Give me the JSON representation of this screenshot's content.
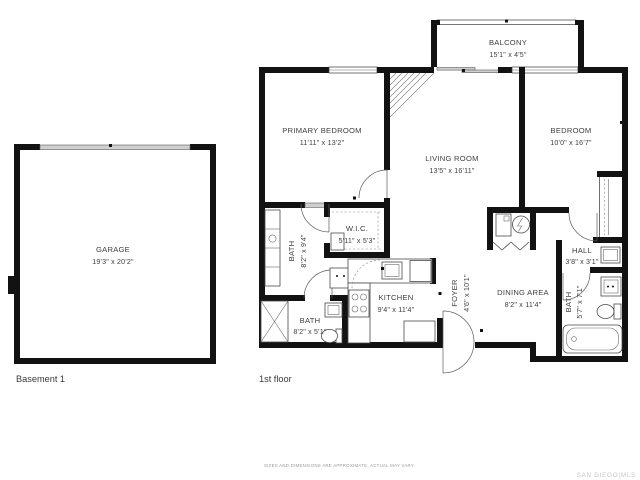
{
  "plan": {
    "basement": {
      "floor_label": "Basement 1",
      "rooms": {
        "garage": {
          "name": "GARAGE",
          "dims": "19'3\" x 20'2\""
        }
      }
    },
    "first_floor": {
      "floor_label": "1st floor",
      "rooms": {
        "balcony": {
          "name": "BALCONY",
          "dims": "15'1\" x 4'5\""
        },
        "primary_bedroom": {
          "name": "PRIMARY BEDROOM",
          "dims": "11'11\" x 13'2\""
        },
        "living_room": {
          "name": "LIVING ROOM",
          "dims": "13'5\" x 16'11\""
        },
        "bedroom": {
          "name": "BEDROOM",
          "dims": "10'0\" x 16'7\""
        },
        "wic": {
          "name": "W.I.C.",
          "dims": "5'11\" x 5'3\""
        },
        "bath_primary": {
          "name": "BATH",
          "dims": "8'2\" x 9'4\""
        },
        "bath_lower": {
          "name": "BATH",
          "dims": "8'2\" x 5'1\""
        },
        "bath_hall": {
          "name": "BATH",
          "dims": "5'7\" x 7'1\""
        },
        "kitchen": {
          "name": "KITCHEN",
          "dims": "9'4\" x 11'4\""
        },
        "foyer": {
          "name": "FOYER",
          "dims": "4'6\" x 10'1\""
        },
        "dining": {
          "name": "DINING AREA",
          "dims": "8'2\" x 11'4\""
        },
        "hall": {
          "name": "HALL",
          "dims": "3'8\" x 3'1\""
        }
      }
    },
    "footer": {
      "disclaimer": "SIZES AND DIMENSIONS ARE APPROXIMATE, ACTUAL MAY VARY.",
      "brand": "SAN DIEGO|MLS"
    },
    "colors": {
      "wall": "#121212",
      "text": "#3e3e3e",
      "door_bar": "#cfcfcf",
      "brand": "#c6c6ca"
    }
  }
}
